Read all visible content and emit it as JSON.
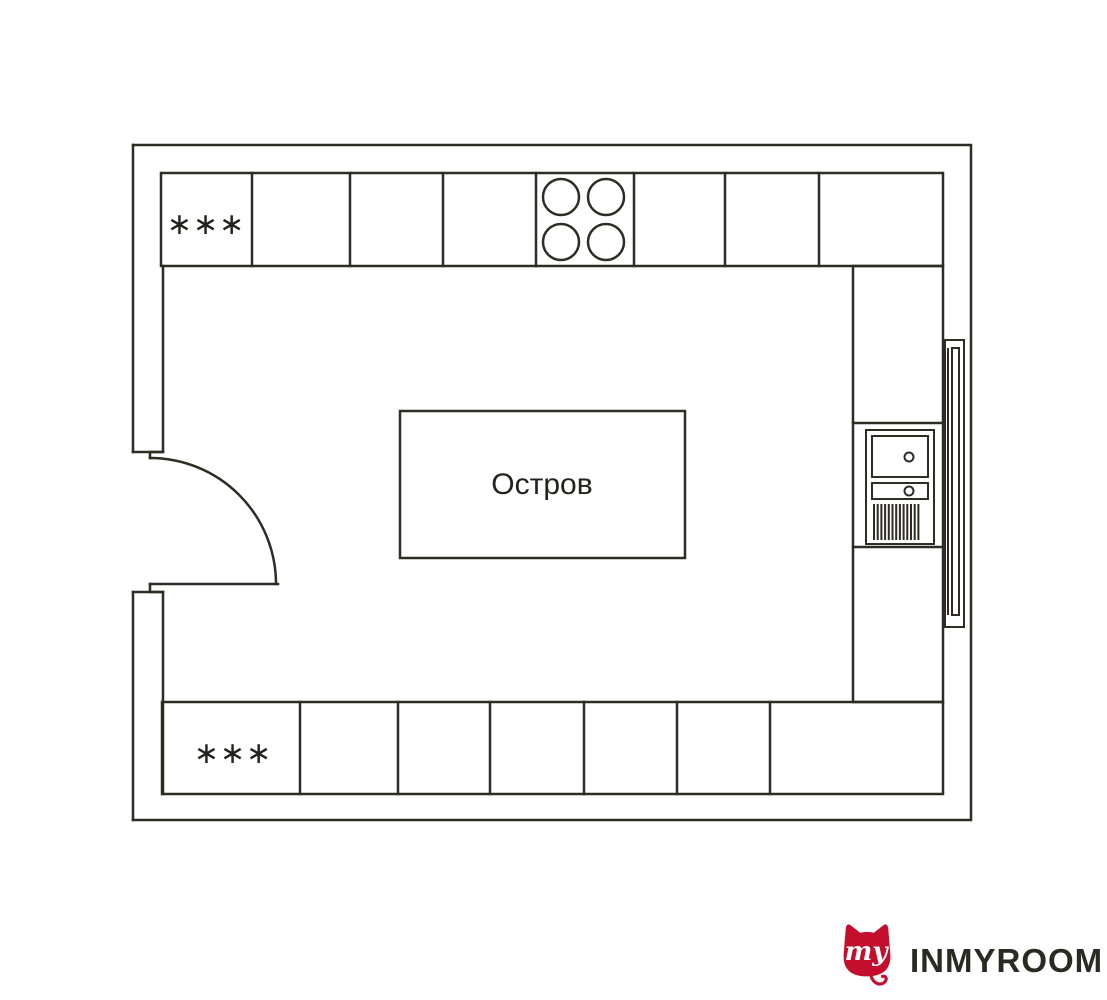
{
  "colors": {
    "background": "#ffffff",
    "plan_line": "#2e2c23",
    "plan_text": "#23221c",
    "logo_red": "#c30e2e",
    "logo_wordmark_text": "#2b2a22",
    "logo_monogram_text": "#ffffff"
  },
  "plan": {
    "island_label": "Остров",
    "top_cabinet_marker": "∗∗∗",
    "bottom_cabinet_marker": "∗∗∗"
  },
  "logo": {
    "monogram": "my",
    "wordmark": "INMYROOM"
  }
}
